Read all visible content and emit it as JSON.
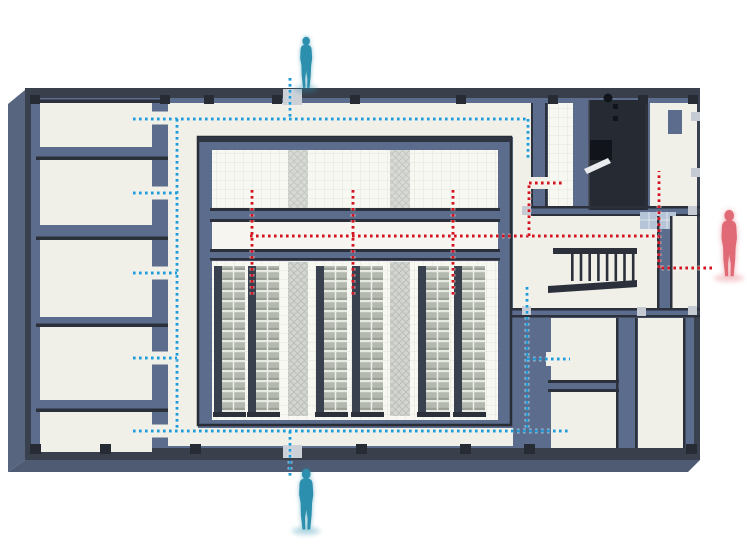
{
  "diagram": {
    "type": "axonometric-floorplan-circulation-diagram",
    "colors": {
      "wall_fill": "#5b6c8c",
      "floor": "#f0efe8",
      "floor_bright": "#f6f5ef",
      "wall_edge": "#2b303b",
      "wall_cap": "#3a404b",
      "wall_cap_dark": "#2e3440",
      "outer_edge": "#3a414e",
      "shaft": "#262b33",
      "glass": "#b5c4d6",
      "extrude_left": "#57657f",
      "extrude_bottom": "#4e5b73",
      "rack_side": "#39414f",
      "pier": "#262b34",
      "pier_light": "#c6cbd3",
      "door_gap": "#ccd1d8",
      "visitor_route": "#1e9bd7",
      "secure_route": "#d31420",
      "visitor_person": "#2c8fad",
      "staff_person": "#e06b76"
    },
    "people": [
      {
        "id": "person-top",
        "role": "visitor",
        "color": "#2c8fad",
        "x": 306,
        "y": 36,
        "height": 54
      },
      {
        "id": "person-bottom",
        "role": "visitor",
        "color": "#2c8fad",
        "x": 306,
        "y": 468,
        "height": 64
      },
      {
        "id": "person-right",
        "role": "staff",
        "color": "#e06b76",
        "x": 729,
        "y": 209,
        "height": 70
      }
    ],
    "routes": [
      {
        "id": "visitor-route-blue",
        "color": "#1e9bd7",
        "segments": [
          [
            [
              290,
              78
            ],
            [
              290,
              119
            ]
          ],
          [
            [
              133,
              119
            ],
            [
              528,
              119
            ]
          ],
          [
            [
              528,
              119
            ],
            [
              528,
              158
            ]
          ],
          [
            [
              177,
              119
            ],
            [
              177,
              431
            ]
          ],
          [
            [
              133,
              193
            ],
            [
              177,
              193
            ]
          ],
          [
            [
              133,
              273
            ],
            [
              177,
              273
            ]
          ],
          [
            [
              133,
              358
            ],
            [
              177,
              358
            ]
          ],
          [
            [
              133,
              431
            ],
            [
              568,
              431
            ]
          ],
          [
            [
              290,
              431
            ],
            [
              290,
              478
            ]
          ],
          [
            [
              527,
              287
            ],
            [
              527,
              431
            ]
          ],
          [
            [
              527,
              359
            ],
            [
              570,
              359
            ]
          ]
        ]
      },
      {
        "id": "secure-route-red",
        "color": "#d31420",
        "segments": [
          [
            [
              712,
              268
            ],
            [
              659,
              268
            ]
          ],
          [
            [
              659,
              268
            ],
            [
              659,
              171
            ]
          ],
          [
            [
              250,
              236
            ],
            [
              659,
              236
            ]
          ],
          [
            [
              529,
              236
            ],
            [
              529,
              183
            ]
          ],
          [
            [
              529,
              183
            ],
            [
              563,
              183
            ]
          ],
          [
            [
              252,
              190
            ],
            [
              252,
              295
            ]
          ],
          [
            [
              353,
              190
            ],
            [
              353,
              295
            ]
          ],
          [
            [
              453,
              190
            ],
            [
              453,
              295
            ]
          ]
        ]
      }
    ],
    "left_rooms": [
      {
        "y": 103,
        "h": 44
      },
      {
        "y": 160,
        "h": 65
      },
      {
        "y": 240,
        "h": 77
      },
      {
        "y": 327,
        "h": 73
      },
      {
        "y": 412,
        "h": 40
      }
    ],
    "left_doors": [
      118,
      193,
      273,
      358,
      431
    ],
    "racks": {
      "y": 266,
      "h": 148,
      "strips": [
        {
          "x": 214,
          "w": 31,
          "kind": "rack"
        },
        {
          "x": 248,
          "w": 31,
          "kind": "rack"
        },
        {
          "x": 288,
          "w": 20,
          "kind": "mesh"
        },
        {
          "x": 316,
          "w": 31,
          "kind": "rack"
        },
        {
          "x": 352,
          "w": 31,
          "kind": "rack"
        },
        {
          "x": 390,
          "w": 20,
          "kind": "mesh"
        },
        {
          "x": 418,
          "w": 31,
          "kind": "rack"
        },
        {
          "x": 454,
          "w": 31,
          "kind": "rack"
        }
      ]
    },
    "stairs": {
      "x0": 571,
      "step": 8.7,
      "count": 8,
      "y": 253,
      "h": 28
    },
    "pillars": {
      "top": [
        30,
        160,
        204,
        272,
        350,
        456,
        548,
        638,
        688
      ],
      "bottom": [
        30,
        100,
        190,
        356,
        460,
        524,
        686
      ],
      "squares": [
        [
          522,
          206
        ],
        [
          688,
          206
        ],
        [
          522,
          306
        ],
        [
          637,
          307
        ],
        [
          688,
          306
        ],
        [
          691,
          112
        ],
        [
          691,
          168
        ]
      ]
    }
  }
}
